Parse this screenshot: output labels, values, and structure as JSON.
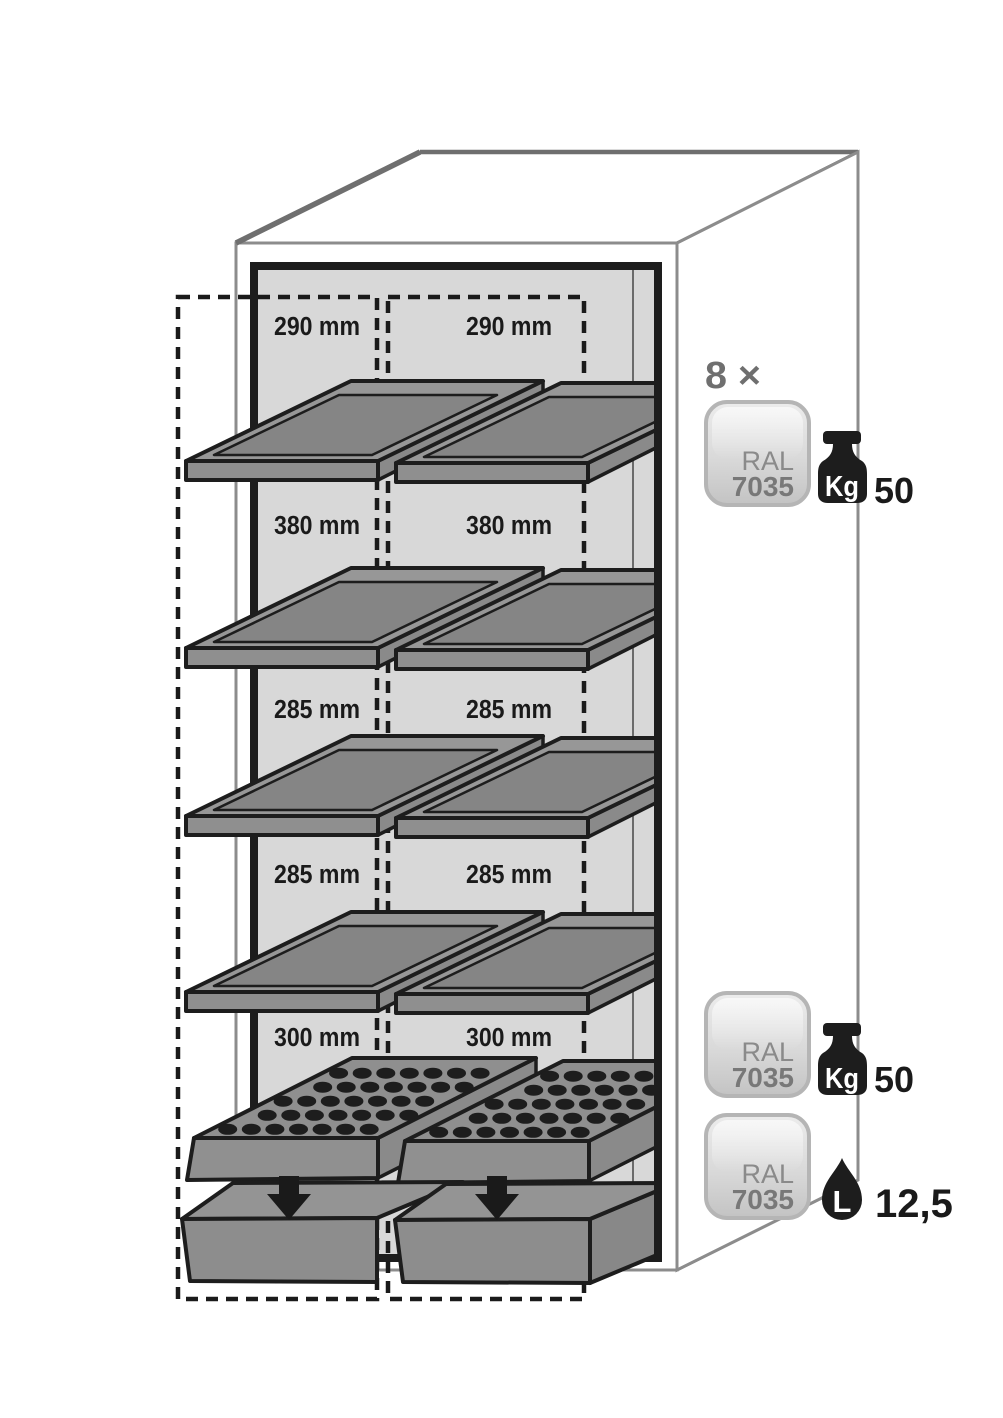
{
  "diagram": {
    "compartment_rows": [
      {
        "left": "290 mm",
        "right": "290 mm"
      },
      {
        "left": "380 mm",
        "right": "380 mm"
      },
      {
        "left": "285 mm",
        "right": "285 mm"
      },
      {
        "left": "285 mm",
        "right": "285 mm"
      },
      {
        "left": "300 mm",
        "right": "300 mm"
      }
    ]
  },
  "legend": {
    "shelf_quantity": "8 ×",
    "shelf_badge": {
      "ral_label": "RAL",
      "ral_code": "7035",
      "capacity_unit": "Kg",
      "capacity_value": "50"
    },
    "perforated_badge": {
      "ral_label": "RAL",
      "ral_code": "7035",
      "capacity_unit": "Kg",
      "capacity_value": "50"
    },
    "sump_badge": {
      "ral_label": "RAL",
      "ral_code": "7035",
      "capacity_unit": "L",
      "capacity_value": "12,5"
    }
  },
  "colors": {
    "ink": "#1a1a1a",
    "cabinet_line": "#8c8c8c",
    "interior_gray": "#d8d8d8",
    "shelf_gray": "#8f8f8f",
    "badge_border": "#b5b5b5",
    "muted_text": "#6f6f6f"
  }
}
